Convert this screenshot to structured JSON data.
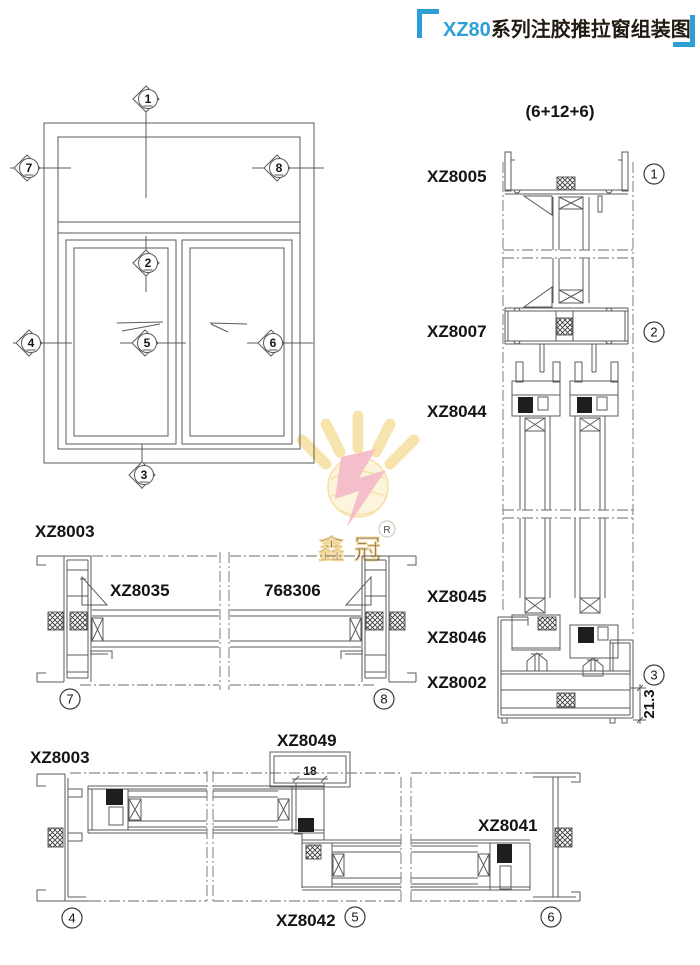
{
  "title": {
    "series": "XZ80",
    "name": "系列注胶推拉窗组装图"
  },
  "elevation": {
    "markers": {
      "top": "1",
      "transom": "2",
      "bottom": "3",
      "left_sash": "4",
      "meeting": "5",
      "right_sash": "6",
      "left_jamb": "7",
      "right_jamb": "8"
    }
  },
  "vertical_section": {
    "glass_spec": "(6+12+6)",
    "profiles": {
      "top_frame": "XZ8005",
      "transom": "XZ8007",
      "sash_top": "XZ8044",
      "sash_bottom_a": "XZ8045",
      "sash_bottom_b": "XZ8046",
      "sill": "XZ8002"
    },
    "markers": {
      "head": "1",
      "transom": "2",
      "sill": "3"
    },
    "sill_height_dim": "21.3"
  },
  "mid_section": {
    "jamb": "XZ8003",
    "bead": "XZ8035",
    "glass": "768306",
    "markers": {
      "left": "7",
      "right": "8"
    }
  },
  "bottom_section": {
    "jamb": "XZ8003",
    "keeper": "XZ8049",
    "lock_stile": "XZ8041",
    "interlock": "XZ8042",
    "overlap_dim": "18",
    "markers": {
      "left": "4",
      "middle": "5",
      "right": "6"
    }
  },
  "watermark": {
    "brand": "鑫冠",
    "registered": "R"
  }
}
